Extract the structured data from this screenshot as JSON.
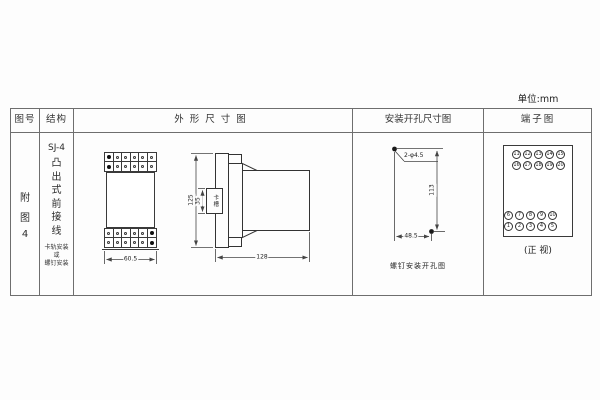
{
  "unit_label": "单位:mm",
  "headers": {
    "fig_no": "图号",
    "structure": "结构",
    "outline": "外形尺寸图",
    "mounting": "安装开孔尺寸图",
    "terminal": "端子图"
  },
  "fig_no": {
    "lines": [
      "附",
      "图",
      "4"
    ]
  },
  "structure": {
    "model": "SJ-4",
    "type_chars": [
      "凸",
      "出",
      "式",
      "前",
      "接",
      "线"
    ],
    "mount_note": [
      "卡轨安装",
      "或",
      "螺钉安装"
    ]
  },
  "outline": {
    "front_width": "60.5",
    "overall_height": "125",
    "slot_height": "35",
    "slot_label": "卡槽",
    "overall_depth": "128"
  },
  "mounting": {
    "holes_label": "2-φ4.5",
    "vertical_spacing": "113",
    "horizontal_spacing": "48.5",
    "caption": "螺钉安装开孔图"
  },
  "terminal": {
    "rows": [
      [
        "11",
        "12",
        "13",
        "14",
        "15"
      ],
      [
        "16",
        "17",
        "18",
        "19",
        "20"
      ],
      [
        "6",
        "7",
        "8",
        "9",
        "10"
      ],
      [
        "1",
        "2",
        "3",
        "4",
        "5"
      ]
    ],
    "caption": "(正 视)"
  }
}
